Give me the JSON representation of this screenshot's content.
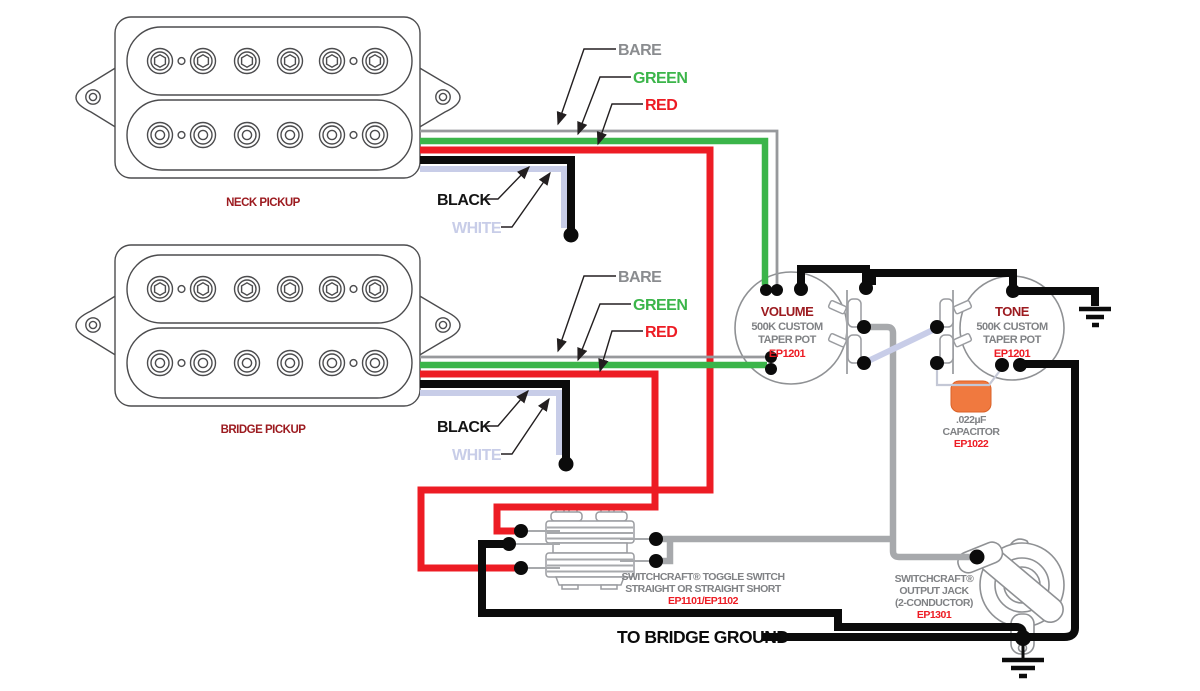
{
  "wire_labels": {
    "bare": "BARE",
    "green": "GREEN",
    "red": "RED",
    "black": "BLACK",
    "white": "WHITE"
  },
  "pickups": {
    "neck": "NECK PICKUP",
    "bridge": "BRIDGE PICKUP"
  },
  "volume_pot": {
    "name": "VOLUME",
    "spec1": "500K CUSTOM",
    "spec2": "TAPER POT",
    "part": "EP1201"
  },
  "tone_pot": {
    "name": "TONE",
    "spec1": "500K CUSTOM",
    "spec2": "TAPER POT",
    "part": "EP1201"
  },
  "capacitor": {
    "value": ".022µF",
    "name": "CAPACITOR",
    "part": "EP1022"
  },
  "toggle_switch": {
    "name": "SWITCHCRAFT® TOGGLE SWITCH",
    "type": "STRAIGHT OR STRAIGHT SHORT",
    "part": "EP1101/EP1102"
  },
  "output_jack": {
    "brand": "SWITCHCRAFT®",
    "name": "OUTPUT JACK",
    "type": "(2-CONDUCTOR)",
    "part": "EP1301"
  },
  "ground_note": "TO BRIDGE GROUND",
  "colors": {
    "red_wire": "#ed1c24",
    "green_wire": "#3bb54a",
    "black_wire": "#0b0b0b",
    "white_wire": "#c8cde8",
    "bare_wire": "#97999c",
    "shielded_gray_wire": "#a7a9ac",
    "label_gray": "#808285",
    "maroon_label": "#9c1b20",
    "part_number_red": "#ed1c24",
    "capacitor_orange": "#f0793f"
  }
}
